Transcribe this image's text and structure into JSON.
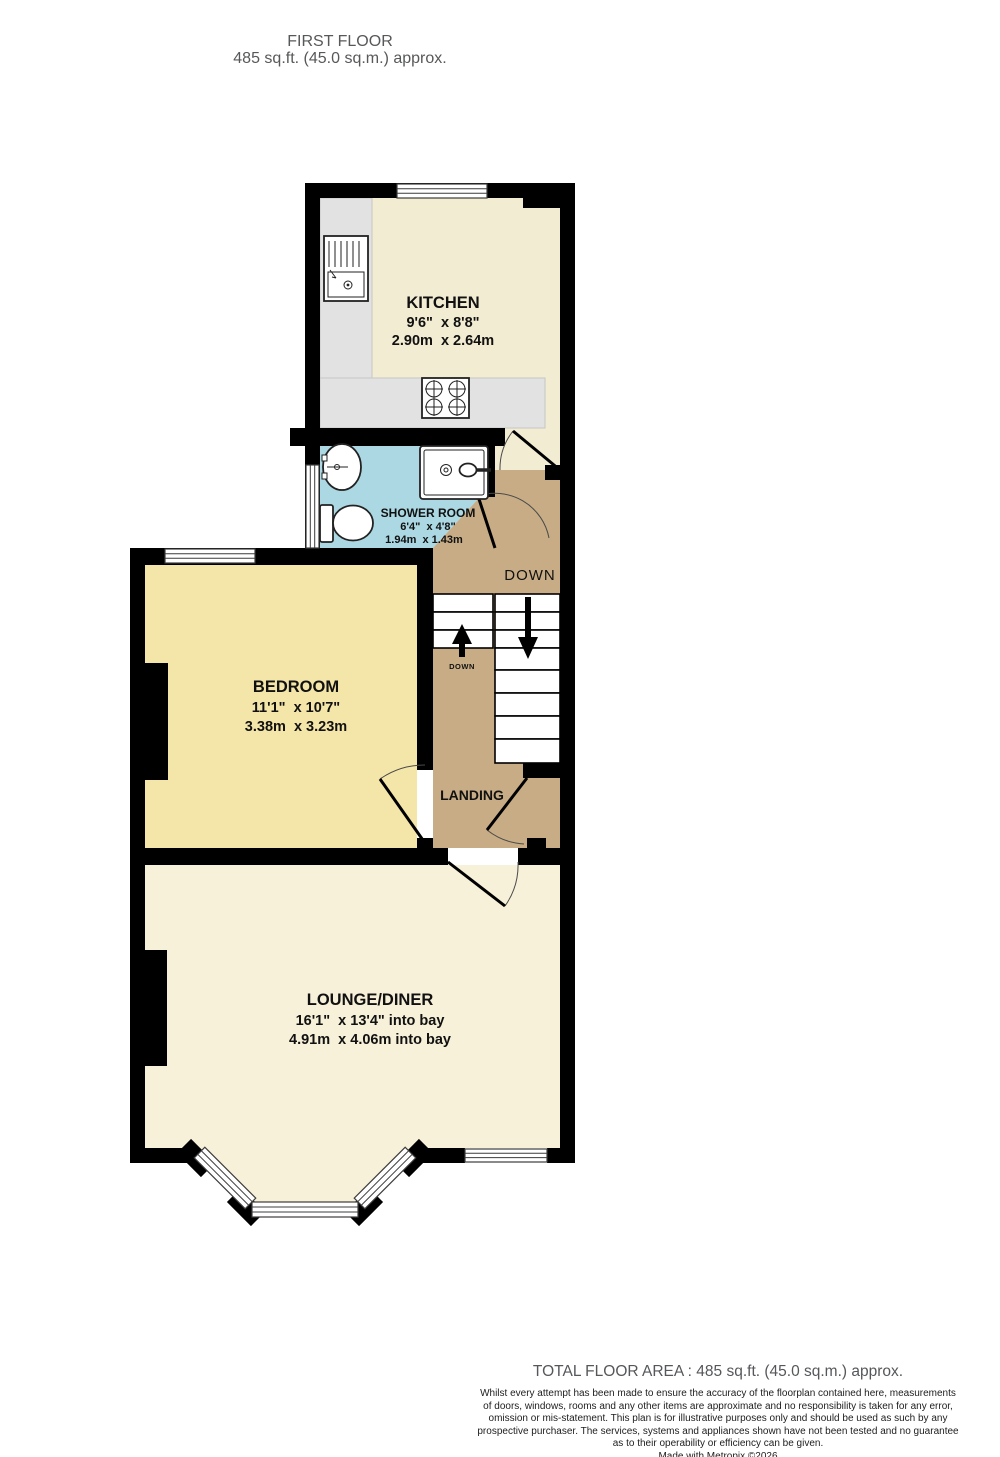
{
  "header": {
    "title": "FIRST FLOOR",
    "subtitle": "485 sq.ft. (45.0 sq.m.) approx."
  },
  "rooms": {
    "kitchen": {
      "name": "KITCHEN",
      "imperial": "9'6\"  x 8'8\"",
      "metric": "2.90m  x 2.64m"
    },
    "shower": {
      "name": "SHOWER ROOM",
      "imperial": "6'4\"  x 4'8\"",
      "metric": "1.94m  x 1.43m"
    },
    "bedroom": {
      "name": "BEDROOM",
      "imperial": "11'1\"  x 10'7\"",
      "metric": "3.38m  x 3.23m"
    },
    "lounge": {
      "name": "LOUNGE/DINER",
      "imperial": "16'1\"  x 13'4\" into bay",
      "metric": "4.91m  x 4.06m into bay"
    },
    "landing": {
      "name": "LANDING"
    }
  },
  "labels": {
    "down_stairs": "DOWN",
    "down_small": "DOWN"
  },
  "footer": {
    "total": "TOTAL FLOOR AREA : 485 sq.ft. (45.0 sq.m.) approx.",
    "disclaimer_lines": [
      "Whilst every attempt has been made to ensure the accuracy of the floorplan contained here, measurements",
      "of doors, windows, rooms and any other items are approximate and no responsibility is taken for any error,",
      "omission or mis-statement. This plan is for illustrative purposes only and should be used as such by any",
      "prospective purchaser. The services, systems and appliances shown have not been tested and no guarantee",
      "as to their operability or efficiency can be given."
    ],
    "credit": "Made with Metropix ©2026"
  },
  "colors": {
    "kitchen": "#f2ecd2",
    "lounge": "#f7f1d9",
    "bedroom": "#f4e5a9",
    "shower": "#abd8e2",
    "landing": "#c7ac85",
    "counter": "#e2e2e2"
  }
}
